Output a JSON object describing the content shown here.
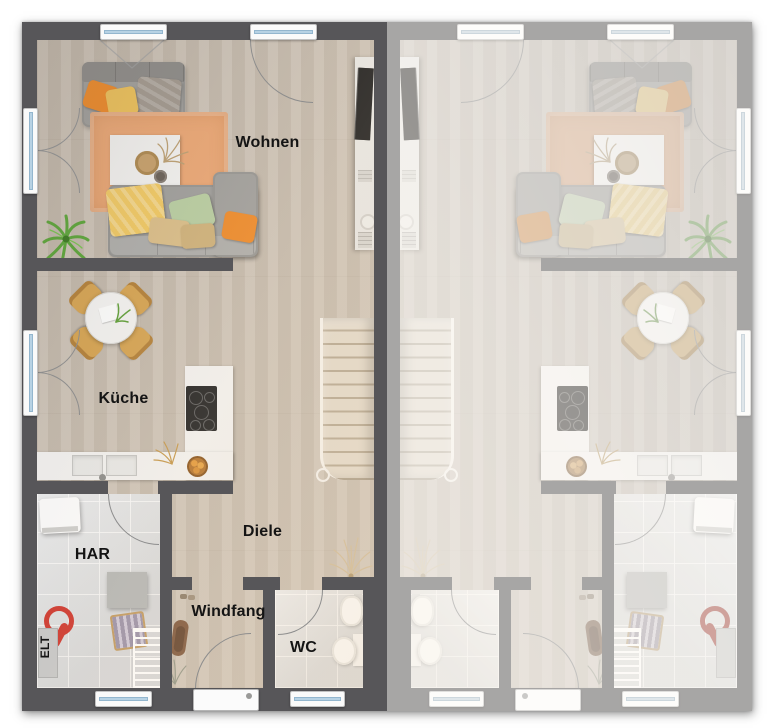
{
  "floorplan": {
    "left_unit": {
      "rooms": {
        "living": "Wohnen",
        "kitchen": "Küche",
        "hall": "Diele",
        "utility_room": "HAR",
        "electrical": "ELT",
        "vestibule": "Windfang",
        "wc": "WC"
      }
    },
    "right_unit": {
      "note_mirrored_unlabeled": ""
    },
    "palette": {
      "wall_dark": "#575659",
      "wall_light_mirror": "#a6a6a8",
      "wood_floor": "#cdc3b6",
      "tile_floor": "#e1e3e5",
      "rug": "#ecaa79",
      "accent_orange": "#ef8d2e",
      "accent_yellow": "#eec35e",
      "accent_green": "#bbcfa4",
      "plant_green": "#5ba838",
      "chair_wood": "#d8a757",
      "stair_wood": "#ddd3c4",
      "label_text": "#141414"
    }
  }
}
